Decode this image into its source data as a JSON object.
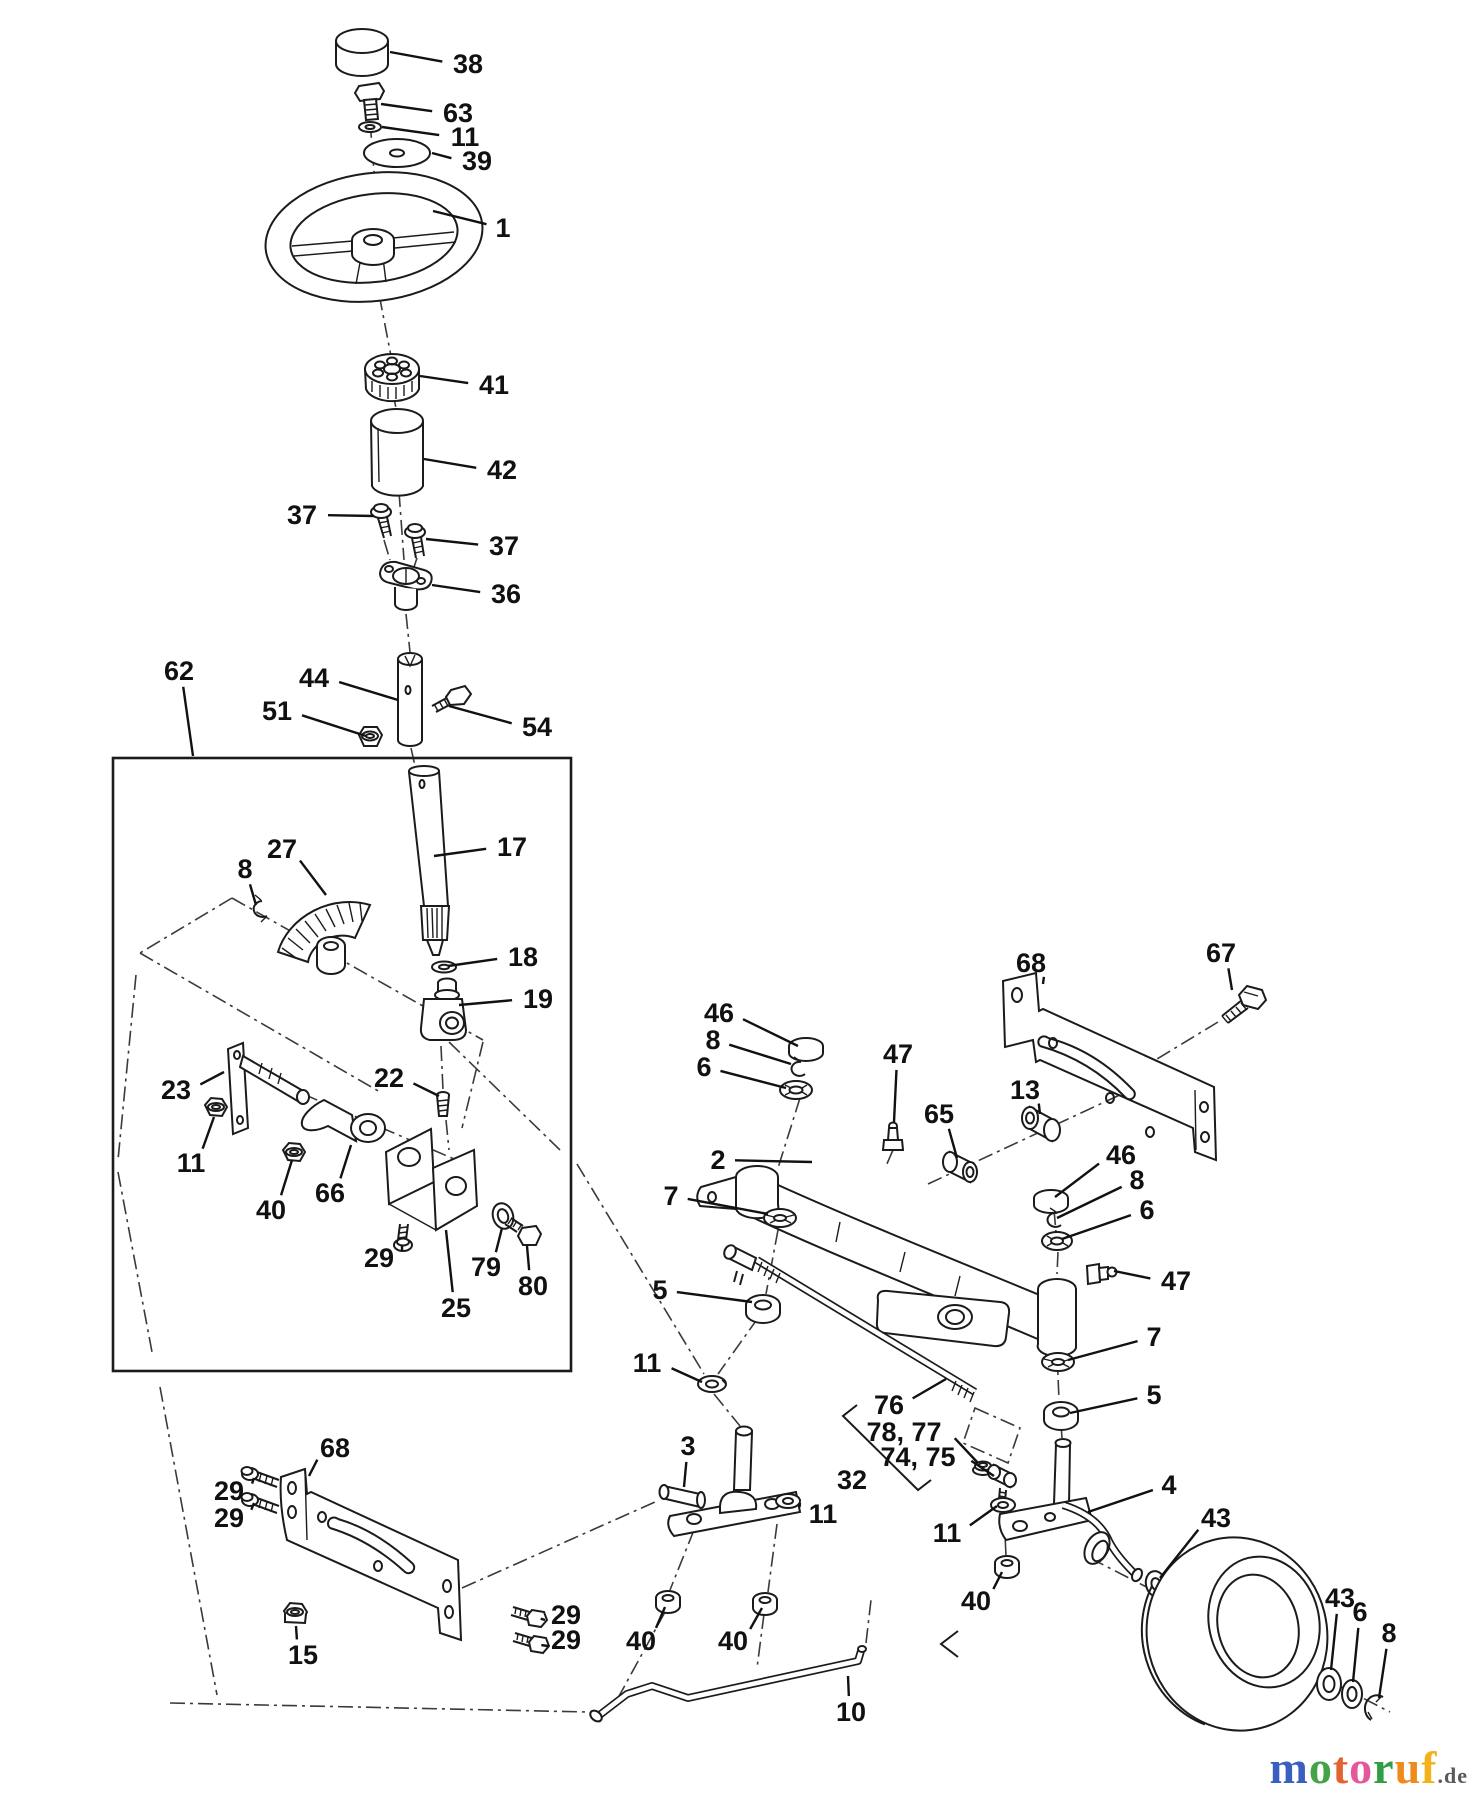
{
  "page": {
    "background": "#ffffff",
    "line_color": "#1b1b1b"
  },
  "logo": {
    "letters": [
      {
        "char": "m",
        "color": "#3b5fc0"
      },
      {
        "char": "o",
        "color": "#45a347"
      },
      {
        "char": "t",
        "color": "#e3622f"
      },
      {
        "char": "o",
        "color": "#e4579b"
      },
      {
        "char": "r",
        "color": "#2f9e44"
      },
      {
        "char": "u",
        "color": "#ef8a1f"
      },
      {
        "char": "f",
        "color": "#f3b21a"
      }
    ],
    "suffix": ".de",
    "suffix_color": "#5a5a5a"
  },
  "diagram": {
    "kind": "exploded-parts-diagram",
    "labels": [
      {
        "t": "38",
        "x": 468,
        "y": 64,
        "w": 21,
        "tx": 390,
        "ty": 52
      },
      {
        "t": "63",
        "x": 458,
        "y": 113,
        "w": 21,
        "tx": 381,
        "ty": 104
      },
      {
        "t": "11",
        "x": 465,
        "y": 137,
        "w": 21,
        "tx": 382,
        "ty": 127
      },
      {
        "t": "39",
        "x": 477,
        "y": 161,
        "w": 21,
        "tx": 432,
        "ty": 153
      },
      {
        "t": "1",
        "x": 503,
        "y": 228,
        "w": 12,
        "tx": 433,
        "ty": 211
      },
      {
        "t": "41",
        "x": 494,
        "y": 385,
        "w": 21,
        "tx": 420,
        "ty": 376
      },
      {
        "t": "42",
        "x": 502,
        "y": 470,
        "w": 21,
        "tx": 424,
        "ty": 459
      },
      {
        "t": "37",
        "x": 302,
        "y": 515,
        "w": 21,
        "tx": 374,
        "ty": 516
      },
      {
        "t": "37",
        "x": 504,
        "y": 546,
        "w": 21,
        "tx": 426,
        "ty": 539
      },
      {
        "t": "36",
        "x": 506,
        "y": 594,
        "w": 21,
        "tx": 432,
        "ty": 585
      },
      {
        "t": "62",
        "x": 179,
        "y": 671,
        "w": 21,
        "tx": 193,
        "ty": 756
      },
      {
        "t": "44",
        "x": 314,
        "y": 678,
        "w": 21,
        "tx": 398,
        "ty": 700
      },
      {
        "t": "51",
        "x": 277,
        "y": 711,
        "w": 21,
        "tx": 366,
        "ty": 736
      },
      {
        "t": "54",
        "x": 537,
        "y": 727,
        "w": 21,
        "tx": 449,
        "ty": 706
      },
      {
        "t": "27",
        "x": 282,
        "y": 849,
        "w": 21,
        "tx": 326,
        "ty": 895
      },
      {
        "t": "8",
        "x": 245,
        "y": 869,
        "w": 12,
        "tx": 256,
        "ty": 905
      },
      {
        "t": "17",
        "x": 512,
        "y": 847,
        "w": 21,
        "tx": 434,
        "ty": 856
      },
      {
        "t": "18",
        "x": 523,
        "y": 957,
        "w": 21,
        "tx": 448,
        "ty": 966
      },
      {
        "t": "19",
        "x": 538,
        "y": 999,
        "w": 21,
        "tx": 459,
        "ty": 1005
      },
      {
        "t": "23",
        "x": 176,
        "y": 1090,
        "w": 21,
        "tx": 224,
        "ty": 1072
      },
      {
        "t": "22",
        "x": 389,
        "y": 1078,
        "w": 21,
        "tx": 439,
        "ty": 1096
      },
      {
        "t": "11",
        "x": 191,
        "y": 1163,
        "w": 21,
        "tx": 214,
        "ty": 1117
      },
      {
        "t": "40",
        "x": 271,
        "y": 1210,
        "w": 21,
        "tx": 292,
        "ty": 1160
      },
      {
        "t": "66",
        "x": 330,
        "y": 1193,
        "w": 21,
        "tx": 351,
        "ty": 1145
      },
      {
        "t": "29",
        "x": 379,
        "y": 1258,
        "w": 21,
        "tx": 402,
        "ty": 1246
      },
      {
        "t": "25",
        "x": 456,
        "y": 1308,
        "w": 21,
        "tx": 446,
        "ty": 1230
      },
      {
        "t": "79",
        "x": 486,
        "y": 1267,
        "w": 21,
        "tx": 502,
        "ty": 1228
      },
      {
        "t": "80",
        "x": 533,
        "y": 1286,
        "w": 21,
        "tx": 527,
        "ty": 1246
      },
      {
        "t": "68",
        "x": 1031,
        "y": 963,
        "w": 21,
        "tx": 1043,
        "ty": 984
      },
      {
        "t": "67",
        "x": 1221,
        "y": 953,
        "w": 21,
        "tx": 1232,
        "ty": 990
      },
      {
        "t": "46",
        "x": 719,
        "y": 1013,
        "w": 21,
        "tx": 798,
        "ty": 1046
      },
      {
        "t": "8",
        "x": 713,
        "y": 1040,
        "w": 12,
        "tx": 791,
        "ty": 1064
      },
      {
        "t": "6",
        "x": 704,
        "y": 1067,
        "w": 12,
        "tx": 786,
        "ty": 1088
      },
      {
        "t": "47",
        "x": 898,
        "y": 1054,
        "w": 21,
        "tx": 894,
        "ty": 1122
      },
      {
        "t": "65",
        "x": 939,
        "y": 1114,
        "w": 21,
        "tx": 957,
        "ty": 1158
      },
      {
        "t": "13",
        "x": 1025,
        "y": 1090,
        "w": 21,
        "tx": 1040,
        "ty": 1114
      },
      {
        "t": "2",
        "x": 718,
        "y": 1160,
        "w": 12,
        "tx": 812,
        "ty": 1162
      },
      {
        "t": "7",
        "x": 671,
        "y": 1196,
        "w": 12,
        "tx": 768,
        "ty": 1214
      },
      {
        "t": "5",
        "x": 660,
        "y": 1290,
        "w": 12,
        "tx": 752,
        "ty": 1302
      },
      {
        "t": "11",
        "x": 647,
        "y": 1363,
        "w": 21,
        "tx": 702,
        "ty": 1382
      },
      {
        "t": "46",
        "x": 1121,
        "y": 1155,
        "w": 21,
        "tx": 1055,
        "ty": 1197
      },
      {
        "t": "8",
        "x": 1137,
        "y": 1180,
        "w": 12,
        "tx": 1057,
        "ty": 1218
      },
      {
        "t": "6",
        "x": 1147,
        "y": 1210,
        "w": 12,
        "tx": 1062,
        "ty": 1239
      },
      {
        "t": "47",
        "x": 1176,
        "y": 1281,
        "w": 21,
        "tx": 1114,
        "ty": 1271
      },
      {
        "t": "7",
        "x": 1154,
        "y": 1337,
        "w": 12,
        "tx": 1068,
        "ty": 1360
      },
      {
        "t": "5",
        "x": 1154,
        "y": 1395,
        "w": 12,
        "tx": 1070,
        "ty": 1413
      },
      {
        "t": "76",
        "x": 889,
        "y": 1405,
        "w": 21,
        "tx": 946,
        "ty": 1379
      },
      {
        "t": "78, 77",
        "x": 904,
        "y": 1432,
        "w": 50,
        "tx": 978,
        "ty": 1463
      },
      {
        "t": "74, 75",
        "x": 918,
        "y": 1457,
        "w": 50,
        "tx": 994,
        "ty": 1476
      },
      {
        "t": "32",
        "x": 852,
        "y": 1480,
        "w": 21
      },
      {
        "t": "11",
        "x": 947,
        "y": 1533,
        "w": 21,
        "tx": 997,
        "ty": 1506
      },
      {
        "t": "40",
        "x": 976,
        "y": 1601,
        "w": 21,
        "tx": 1002,
        "ty": 1572
      },
      {
        "t": "3",
        "x": 688,
        "y": 1446,
        "w": 12,
        "tx": 684,
        "ty": 1487
      },
      {
        "t": "11",
        "x": 823,
        "y": 1514,
        "w": 21,
        "tx": 800,
        "ty": 1503
      },
      {
        "t": "40",
        "x": 641,
        "y": 1641,
        "w": 21,
        "tx": 665,
        "ty": 1607
      },
      {
        "t": "40",
        "x": 733,
        "y": 1641,
        "w": 21,
        "tx": 762,
        "ty": 1608
      },
      {
        "t": "29",
        "x": 566,
        "y": 1615,
        "w": 21,
        "tx": 545,
        "ty": 1620
      },
      {
        "t": "29",
        "x": 566,
        "y": 1640,
        "w": 21,
        "tx": 548,
        "ty": 1646
      },
      {
        "t": "68",
        "x": 335,
        "y": 1448,
        "w": 21,
        "tx": 309,
        "ty": 1476
      },
      {
        "t": "29",
        "x": 229,
        "y": 1491,
        "w": 21,
        "tx": 254,
        "ty": 1478
      },
      {
        "t": "29",
        "x": 229,
        "y": 1518,
        "w": 21,
        "tx": 254,
        "ty": 1503
      },
      {
        "t": "15",
        "x": 303,
        "y": 1655,
        "w": 21,
        "tx": 296,
        "ty": 1626
      },
      {
        "t": "10",
        "x": 851,
        "y": 1712,
        "w": 21,
        "tx": 848,
        "ty": 1676
      },
      {
        "t": "43",
        "x": 1216,
        "y": 1518,
        "w": 21,
        "tx": 1160,
        "ty": 1578
      },
      {
        "t": "4",
        "x": 1169,
        "y": 1485,
        "w": 12,
        "tx": 1088,
        "ty": 1512
      },
      {
        "t": "43",
        "x": 1340,
        "y": 1598,
        "w": 21,
        "tx": 1331,
        "ty": 1670
      },
      {
        "t": "6",
        "x": 1360,
        "y": 1612,
        "w": 12,
        "tx": 1353,
        "ty": 1682
      },
      {
        "t": "8",
        "x": 1389,
        "y": 1633,
        "w": 12,
        "tx": 1379,
        "ty": 1698
      }
    ]
  }
}
